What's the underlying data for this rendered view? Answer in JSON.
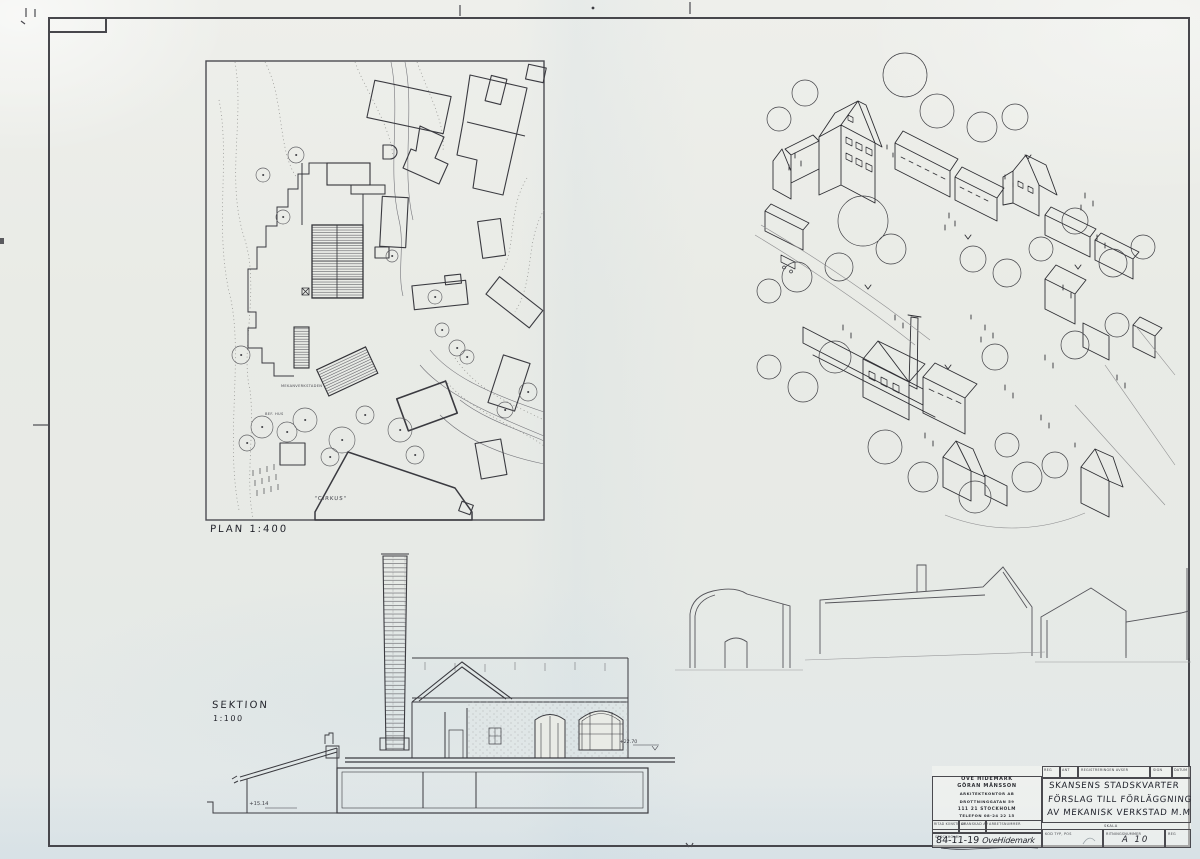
{
  "drawing": {
    "plan_label": "PLAN  1:400",
    "section_label": "SEKTION",
    "section_scale": "1:100",
    "plan": {
      "workshop_note": "MEKANVERKSTADEN",
      "existing_note": "BEF. HUS",
      "cirkus": "\"CIRKUS\""
    },
    "section": {
      "level_low": "+15.14",
      "level_high": "+22.70"
    }
  },
  "title_block": {
    "firm": [
      "OVE HIDEMARK",
      "GÖRAN MÅNSSON",
      "ARKITEKTKONTOR AB",
      "DROTTNINGGATAN 59",
      "111 21 STOCKHOLM",
      "TELEFON 08-24 22 15"
    ],
    "header": {
      "reg": "REG",
      "ant": "ANT",
      "avser": "REGISTRERINGEN AVSER",
      "sign": "SIGN",
      "datum": "DATUM"
    },
    "title_lines": [
      "SKANSENS STADSKVARTER",
      "FÖRSLAG TILL FÖRLÄGGNING",
      "AV MEKANISK VERKSTAD M.M"
    ],
    "labels": {
      "ritad": "RITAD KONSTR AV",
      "granskad": "GRANSKAD AV",
      "arbetsnummer": "ARBETSNUMMER",
      "stockholm": "STOCKHOLM",
      "kod": "KOD  TYP, POS",
      "skala": "SKALA",
      "ritningsnummer": "RITNINGSNUMMER",
      "reg_small": "REG"
    },
    "date": "84-11-19",
    "signature": "OveHidemark",
    "drawing_number": "A 10"
  },
  "colors": {
    "paper": "#e9ebe6",
    "ink": "#3b3b40",
    "faint": "#8b8b8b"
  }
}
